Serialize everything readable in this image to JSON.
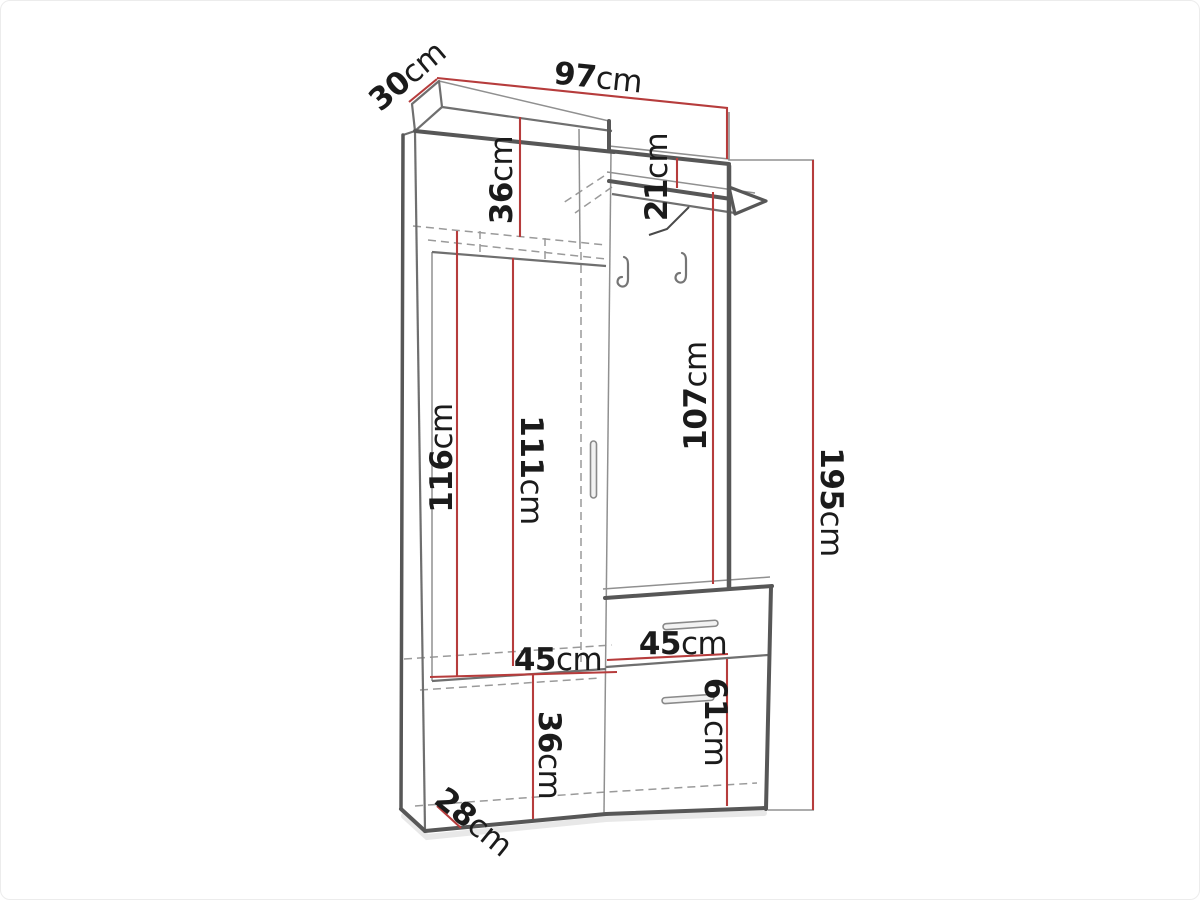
{
  "diagram": {
    "kind": "furniture-technical-drawing",
    "subject": "hallway wardrobe unit with hat shelf, coat hooks, drawer and shoe cabinet"
  },
  "dimensions": {
    "top_depth": {
      "value": "30",
      "unit": "cm"
    },
    "total_width": {
      "value": "97",
      "unit": "cm"
    },
    "upper_cabinet_height": {
      "value": "36",
      "unit": "cm"
    },
    "shelf_drop": {
      "value": "21",
      "unit": "cm"
    },
    "left_interior_height": {
      "value": "116",
      "unit": "cm"
    },
    "door_height": {
      "value": "111",
      "unit": "cm"
    },
    "panel_height": {
      "value": "107",
      "unit": "cm"
    },
    "total_height": {
      "value": "195",
      "unit": "cm"
    },
    "left_interior_width": {
      "value": "45",
      "unit": "cm"
    },
    "drawer_width": {
      "value": "45",
      "unit": "cm"
    },
    "shoe_compartment_height": {
      "value": "36",
      "unit": "cm"
    },
    "lower_door_height": {
      "value": "61",
      "unit": "cm"
    },
    "bottom_depth": {
      "value": "28",
      "unit": "cm"
    }
  },
  "colors": {
    "dimension_line": "#b63c3c",
    "outline_dark": "#575757",
    "outline_mid": "#6f6f6f",
    "outline_light": "#909090",
    "dashed_line": "#9a9a9a",
    "label_text": "#1b1b1b",
    "shadow": "#e0e0e0"
  }
}
